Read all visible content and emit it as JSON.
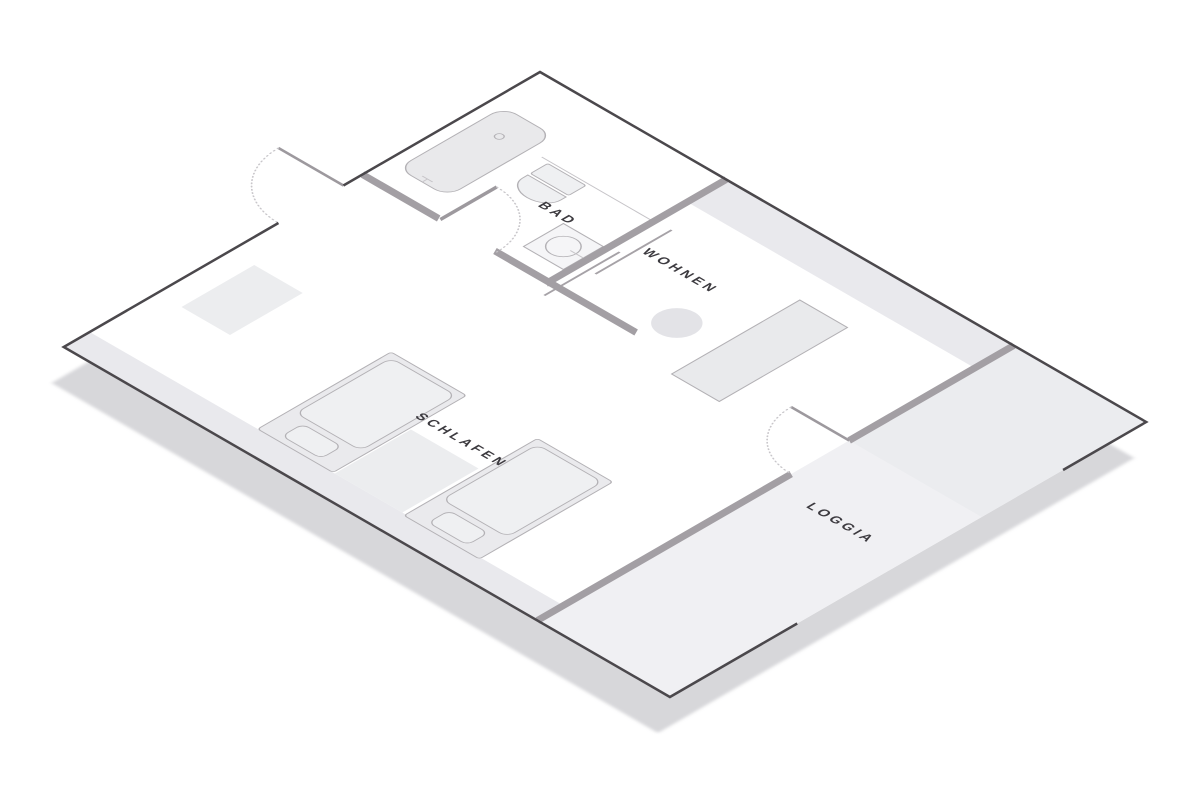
{
  "scene": {
    "kind": "isometric apartment floor plan",
    "rooms": {
      "bad": {
        "label": "BAD"
      },
      "wohnen": {
        "label": "WOHNEN"
      },
      "schlafen": {
        "label": "SCHLAFEN"
      },
      "loggia": {
        "label": "LOGGIA"
      }
    }
  },
  "colors": {
    "canvas": "#ffffff",
    "floor": "#ffffff",
    "band_gray": "#e9e9ed",
    "loggia_gray": "#f0f0f3",
    "nook_gray": "#ebecef",
    "shadow": "#d7d7da",
    "wall_dark": "#4b484c",
    "wall_gray": "#a39fa4",
    "door_leaf": "#9d999e",
    "swing_dots": "#c8c6ca",
    "furniture_fill": "#eaeaed",
    "furniture_fill_light": "#eff0f2",
    "furniture_stroke": "#b3b1b5",
    "thin_line": "#c6c4c8",
    "accent_line": "#a6a2a7",
    "rug": "#ecedef",
    "mat": "#ecedef",
    "plant": "#e3e3e7",
    "sofa": "#e9eaec",
    "tub": "#e9e9eb",
    "sink_fill": "#f5f5f7",
    "label_text": "#3c3a3f"
  }
}
